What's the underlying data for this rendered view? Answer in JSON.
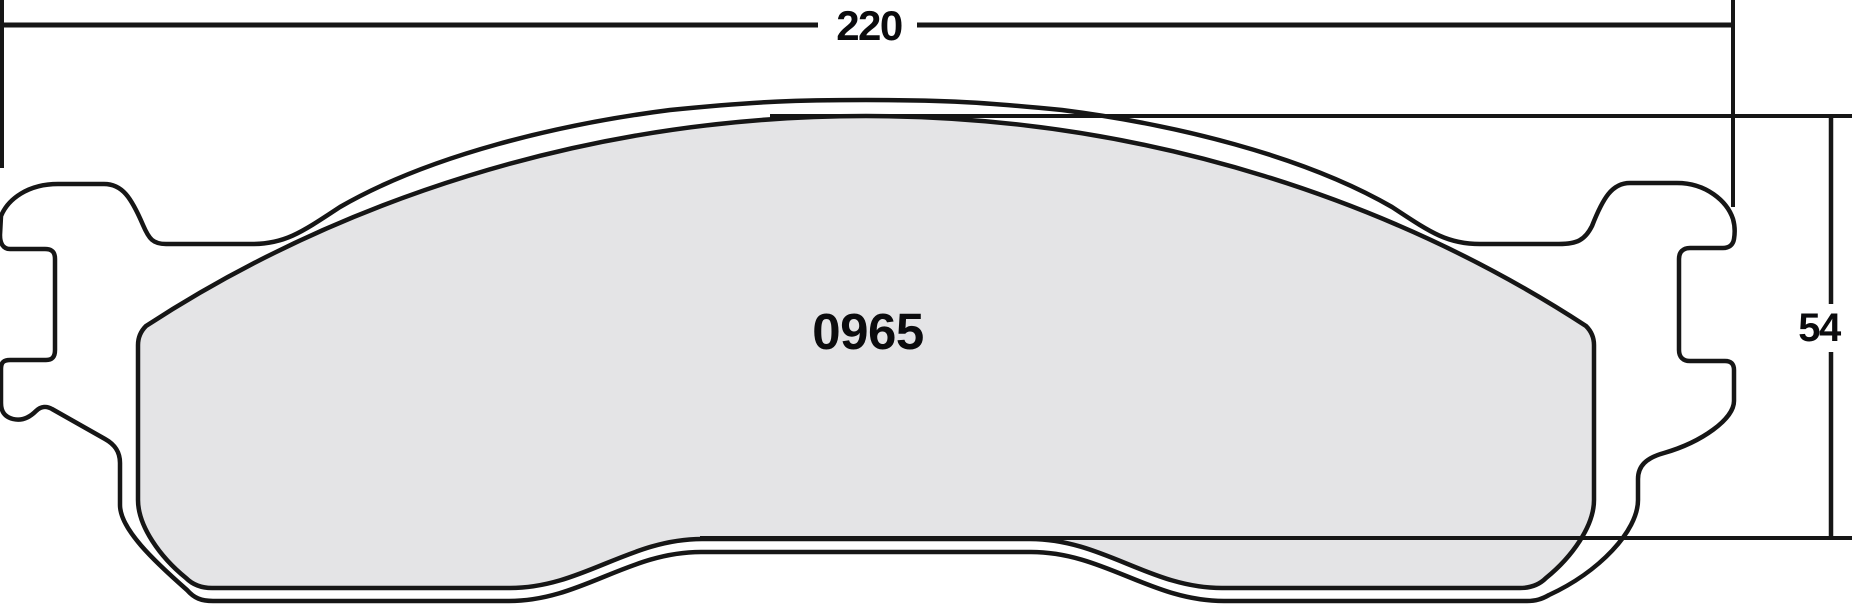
{
  "part_number": "0965",
  "dimensions": {
    "overall_width": "220",
    "overall_height": "54"
  },
  "colors": {
    "line": "#161616",
    "backplate_fill": "#ffffff",
    "friction_fill": "#e4e4e6",
    "background": "#ffffff"
  }
}
